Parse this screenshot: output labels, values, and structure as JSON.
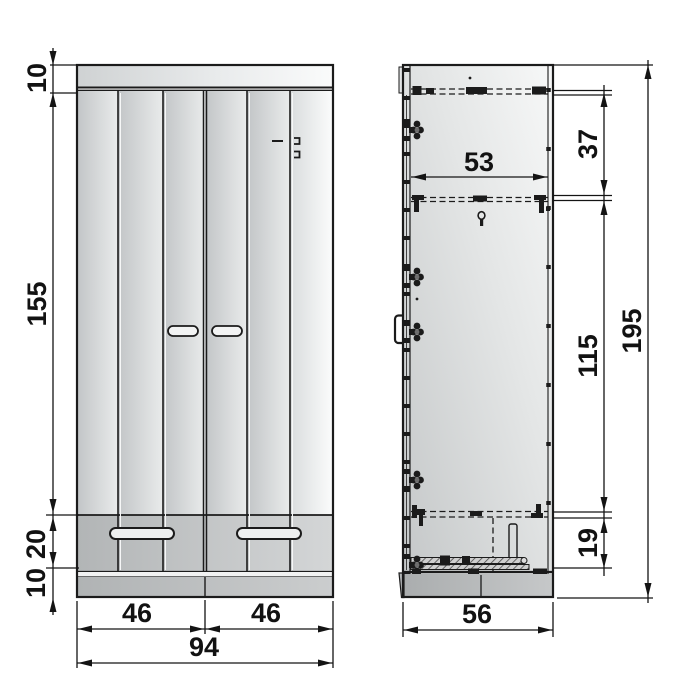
{
  "drawing": {
    "type": "furniture-dimension-diagram",
    "views": [
      "front",
      "side"
    ]
  },
  "front_view": {
    "dims": {
      "top_panel_height": "10",
      "door_height": "155",
      "drawer_height": "20",
      "plinth_height": "10",
      "left_door_width": "46",
      "right_door_width": "46",
      "total_width": "94"
    }
  },
  "side_view": {
    "dims": {
      "inner_depth": "53",
      "upper_section_height": "37",
      "middle_section_height": "115",
      "drawer_section_height": "19",
      "total_height": "195",
      "total_depth": "56"
    }
  },
  "colors": {
    "line": "#1b1b1b",
    "panel_light": "#eceeee",
    "panel_mid": "#c6c9ca",
    "drawer_band": "#b9bcbd",
    "background": "#ffffff"
  }
}
